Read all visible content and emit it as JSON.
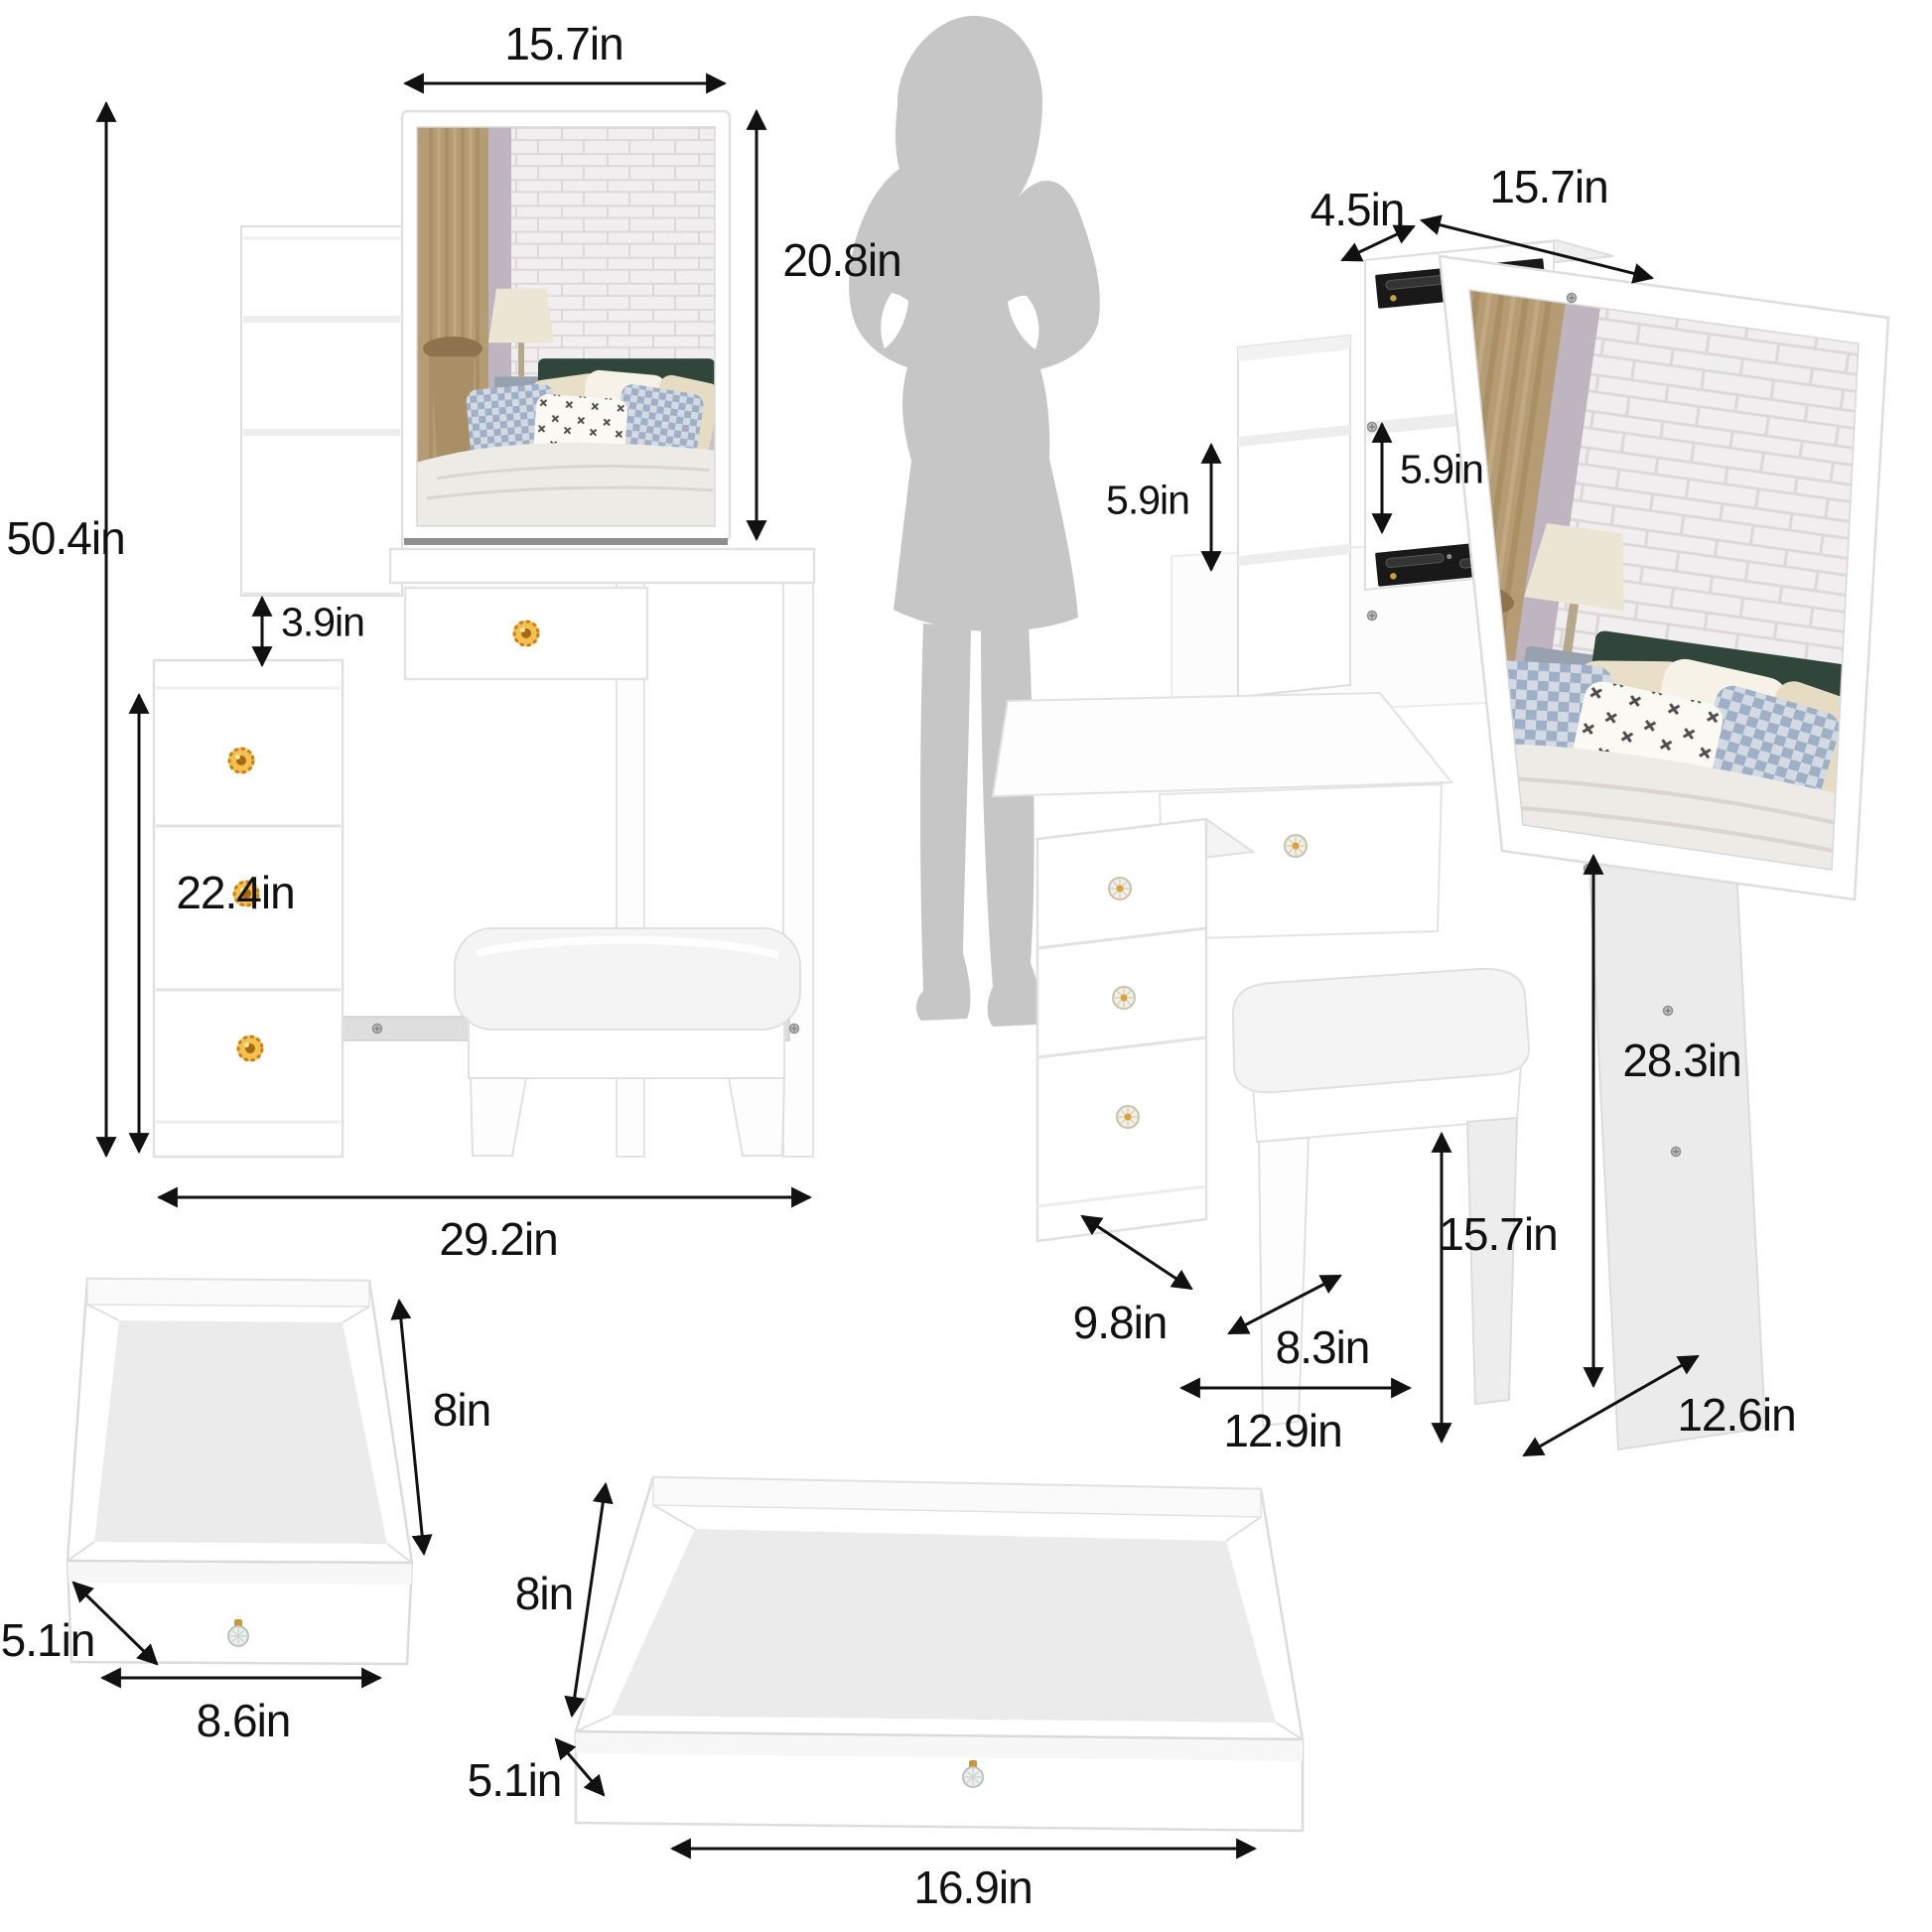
{
  "page": {
    "background": "#ffffff",
    "description_unit": "in"
  },
  "colors": {
    "furniture_white": "#ffffff",
    "outline_gray": "#e0e0e0",
    "silhouette_gray": "#c6c6c6",
    "arrow_black": "#111111",
    "knob_gold": "#e0a135",
    "rail_black": "#191919",
    "headboard_green": "#31463a",
    "panel_gray": "#ebebeb"
  },
  "labels": {
    "front_view": {
      "mirror_width": "15.7in",
      "mirror_height": "20.8in",
      "total_height": "50.4in",
      "shelf_gap": "3.9in",
      "cabinet_height": "22.4in",
      "total_width": "29.2in"
    },
    "side_view": {
      "top_depth": "4.5in",
      "mirror_width": "15.7in",
      "left_shelf_height": "5.9in",
      "right_shelf_height": "5.9in",
      "desk_side_height": "28.3in",
      "stool_height": "15.7in",
      "cabinet_depth": "9.8in",
      "stool_depth": "8.3in",
      "base_depth": "12.9in",
      "panel_depth": "12.6in"
    },
    "small_drawer": {
      "depth": "8in",
      "height": "5.1in",
      "width": "8.6in"
    },
    "large_drawer": {
      "depth": "8in",
      "height": "5.1in",
      "width": "16.9in"
    }
  }
}
